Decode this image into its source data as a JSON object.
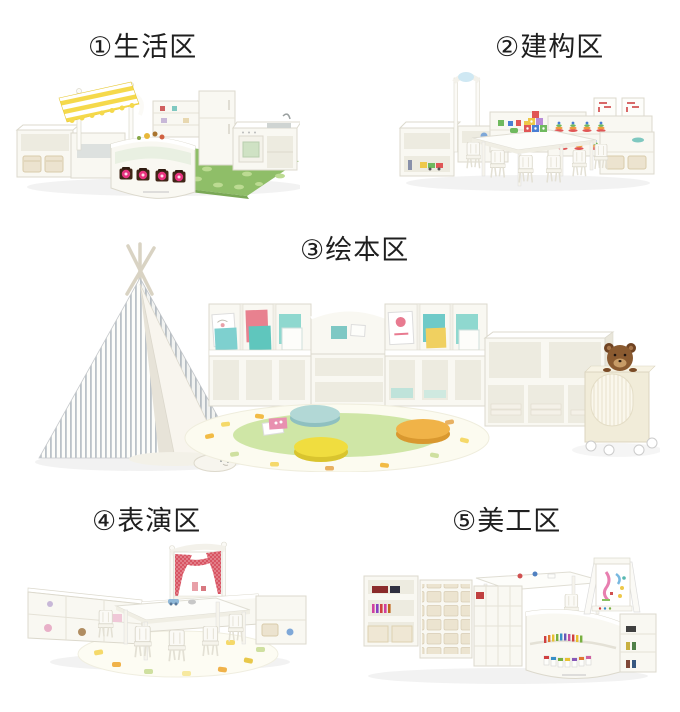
{
  "page": {
    "type": "kindergarten-furniture-zones-catalog"
  },
  "sections": [
    {
      "id": "living-area",
      "label": "①生活区"
    },
    {
      "id": "construction-area",
      "label": "②建构区"
    },
    {
      "id": "picture-book-area",
      "label": "③绘本区"
    },
    {
      "id": "performance-area",
      "label": "④表演区"
    },
    {
      "id": "art-area",
      "label": "⑤美工区"
    }
  ],
  "palette": {
    "background": "#ffffff",
    "label_text": "#1f1f1f",
    "furniture_white": "#f9f8f2",
    "furniture_edge": "#dcd9cd",
    "furniture_inset": "#edebe0",
    "rug_green": "#8fbe68",
    "rug_leaf": "#bcdb92",
    "awning_yellow": "#f5d94b",
    "jar_pink": "#e8337f",
    "teepee_stripe": "#aab3bb",
    "curtain_red": "#d85463",
    "round_rug_green": "#cfe6a6",
    "pouf_blue": "#b2d8d6",
    "pouf_yellow": "#f0dd3f",
    "pouf_orange": "#f0b348",
    "block_red": "#e05656",
    "block_blue": "#4a7fd4",
    "block_green": "#6fb95e",
    "block_yellow": "#eec84a",
    "basket_cream": "#ece3cf"
  }
}
